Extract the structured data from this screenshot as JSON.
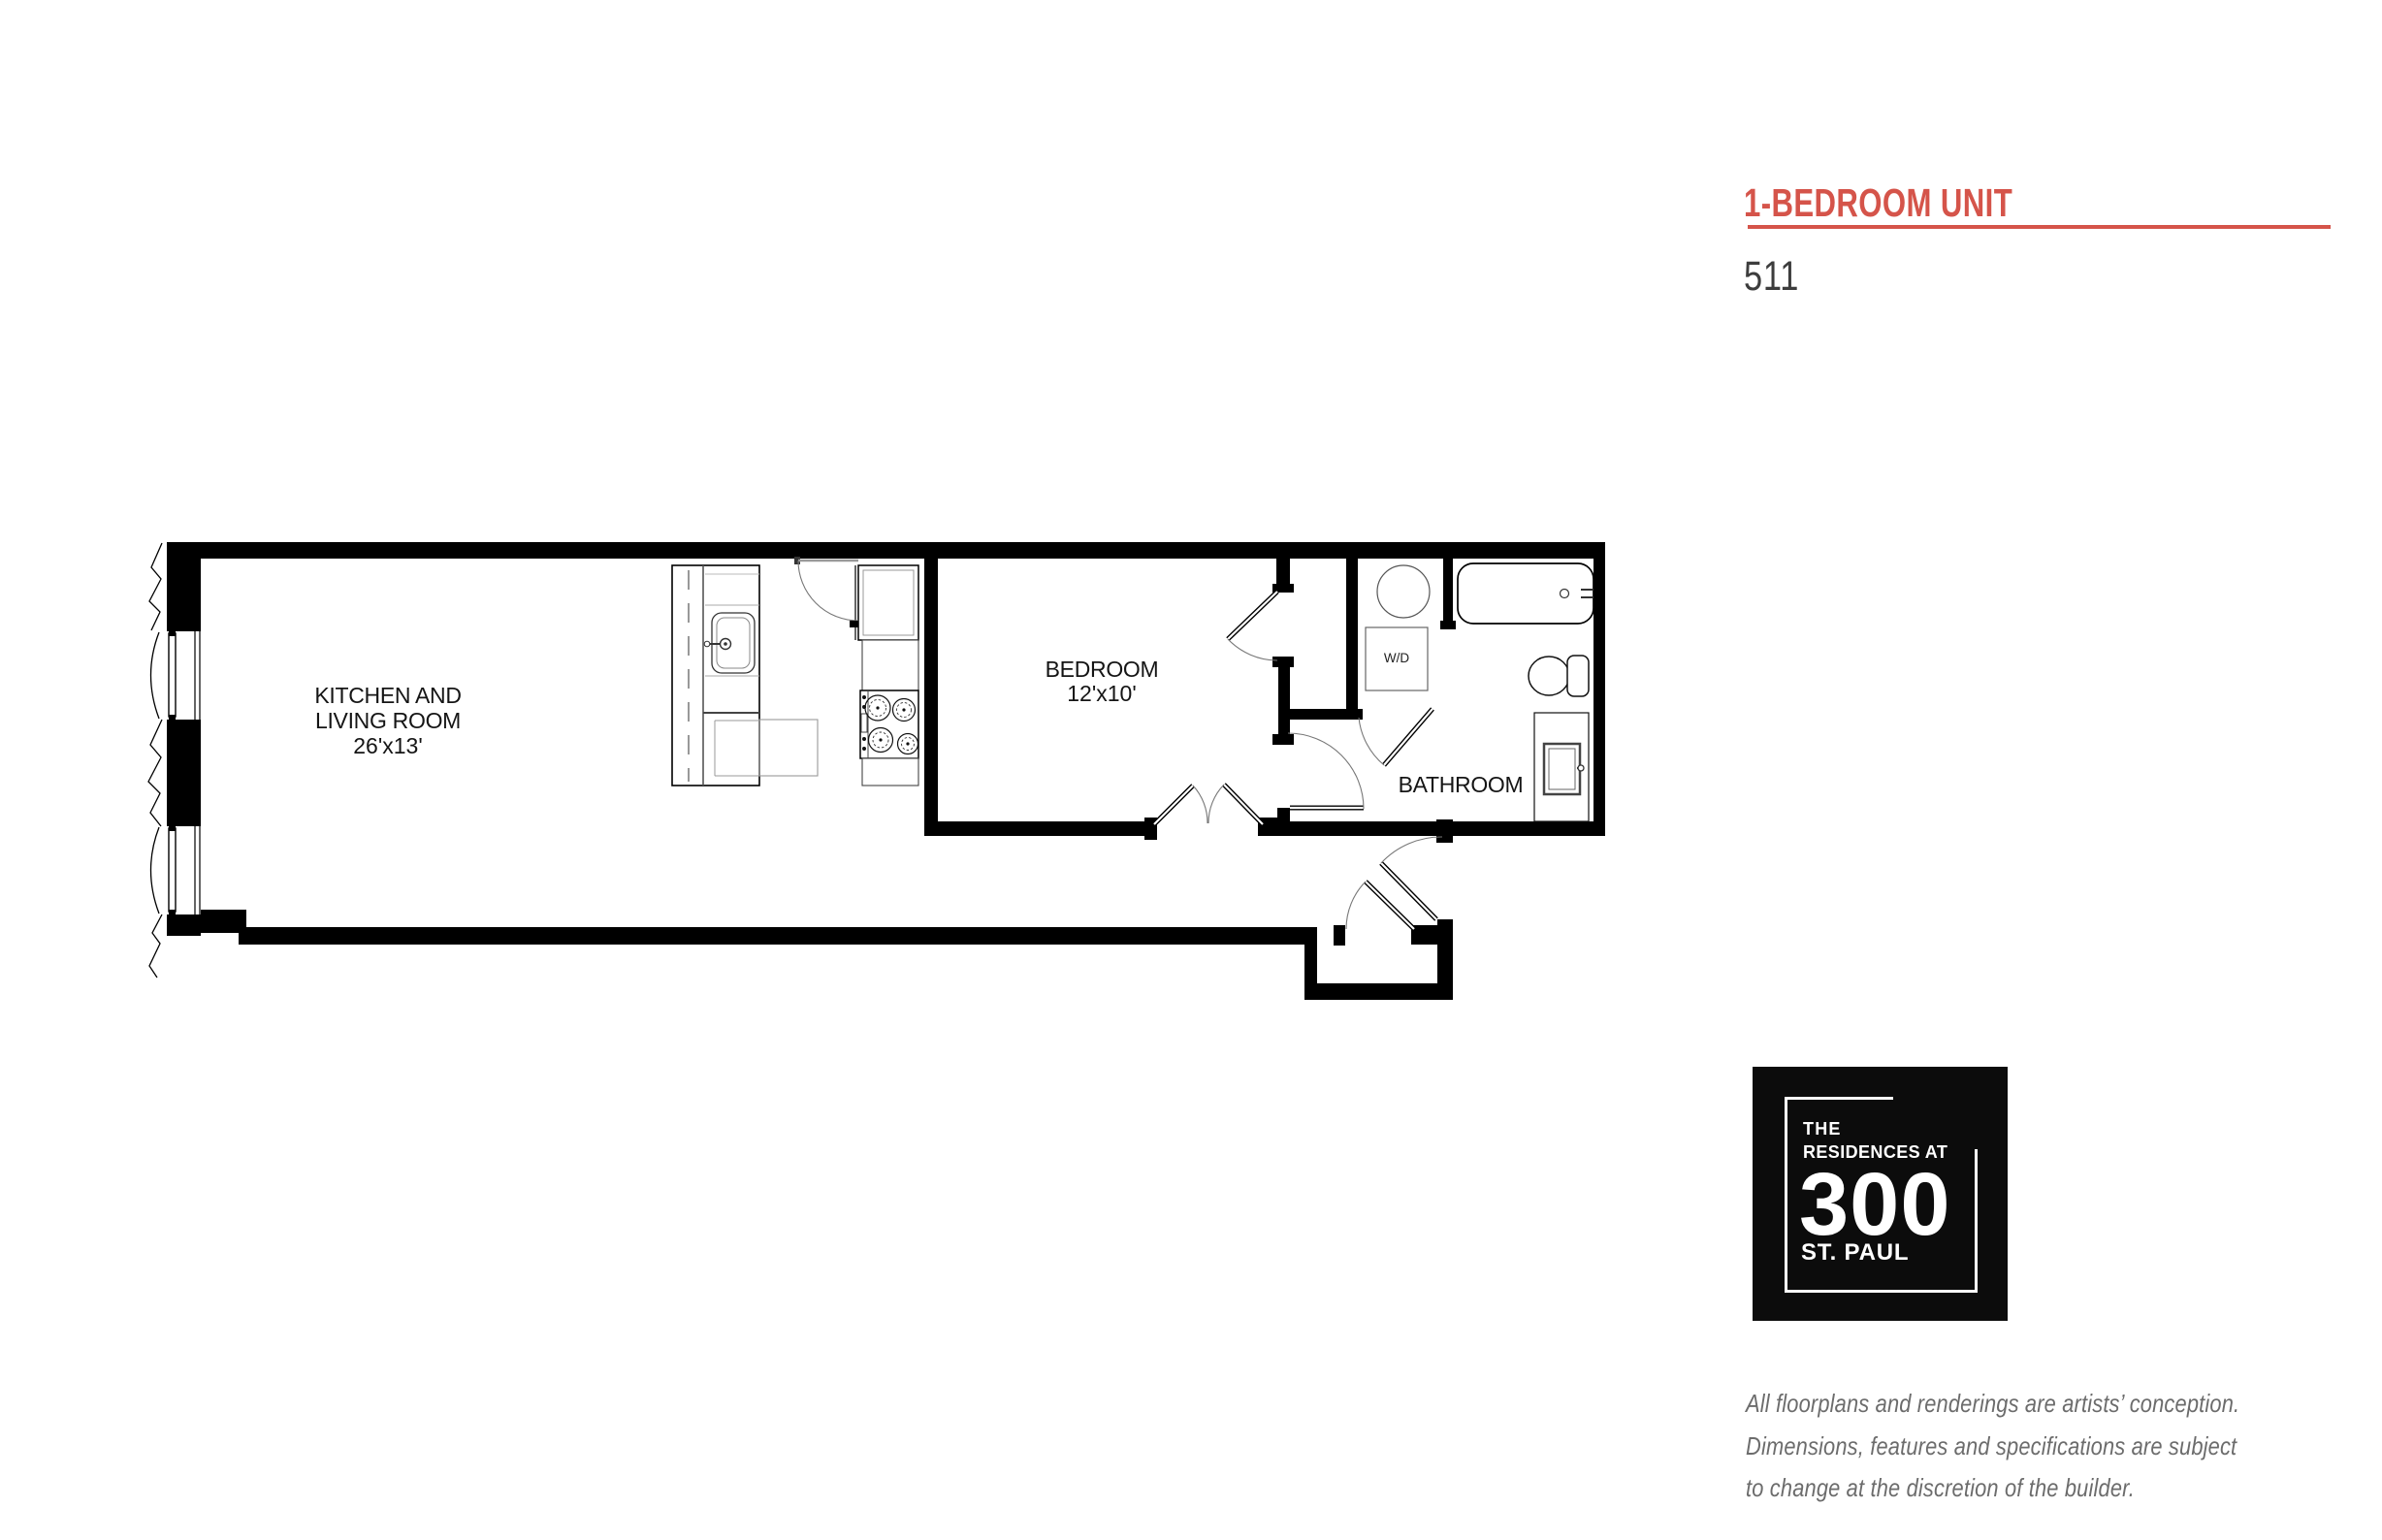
{
  "header": {
    "title": "1-BEDROOM UNIT",
    "unit_number": "511",
    "accent_color": "#d5544a"
  },
  "floorplan": {
    "rooms": [
      {
        "id": "kitchen-living",
        "label_line1": "KITCHEN AND",
        "label_line2": "LIVING ROOM",
        "dimensions": "26'x13'"
      },
      {
        "id": "bedroom",
        "label_line1": "BEDROOM",
        "dimensions": "12'x10'"
      },
      {
        "id": "bathroom",
        "label_line1": "BATHROOM"
      },
      {
        "id": "laundry",
        "label_line1": "W/D"
      }
    ]
  },
  "logo": {
    "line1": "THE",
    "line2": "RESIDENCES AT",
    "line3": "300",
    "line4": "ST. PAUL"
  },
  "disclaimer": {
    "line1": "All floorplans and renderings are artists’ conception.",
    "line2": "Dimensions, features and specifications are subject",
    "line3": "to change at the discretion of the builder."
  }
}
